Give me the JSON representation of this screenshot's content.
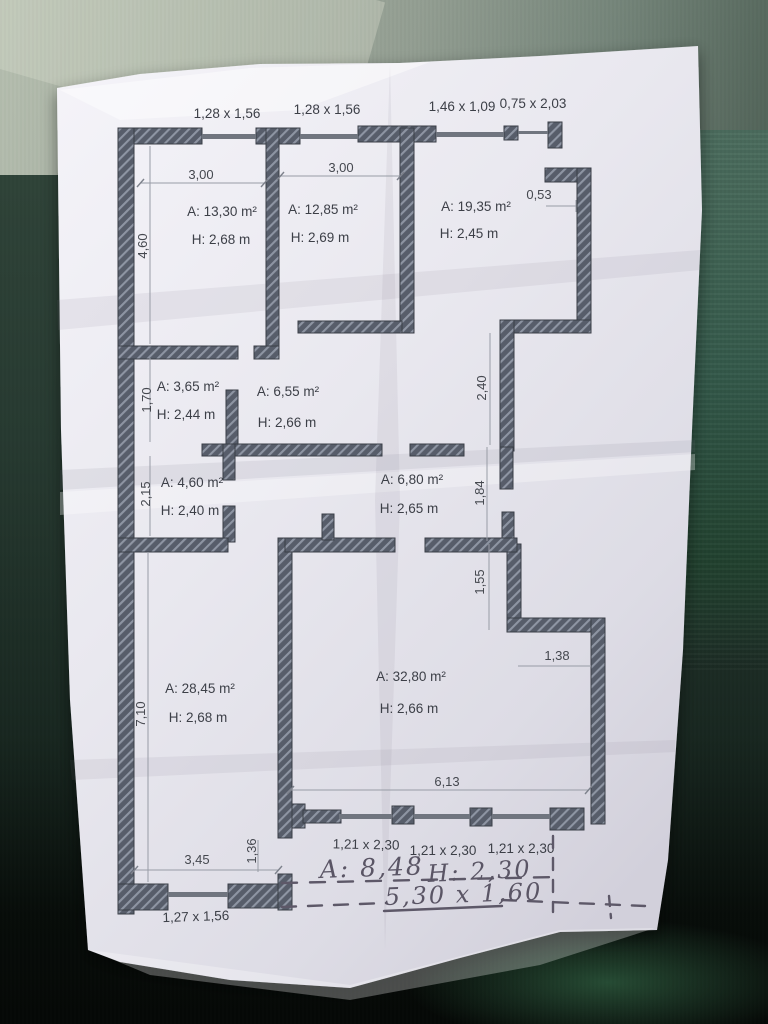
{
  "colors": {
    "paper": "#ebeaf1",
    "wall_fill": "#575d6a",
    "wall_hatch": "#8e95a3",
    "pencil": "#5a5565",
    "table_green": "#27523f",
    "table_top_gray": "#a3ad9f"
  },
  "plan": {
    "top_windows": [
      "1,28 x 1,56",
      "1,28 x 1,56",
      "1,46 x 1,09",
      "0,75 x 2,03"
    ],
    "rooms": {
      "r1": {
        "area": "A: 13,30 m²",
        "height": "H: 2,68 m"
      },
      "r2": {
        "area": "A: 12,85 m²",
        "height": "H: 2,69 m"
      },
      "r3": {
        "area": "A: 19,35 m²",
        "height": "H: 2,45 m"
      },
      "r4": {
        "area": "A: 3,65 m²",
        "height": "H: 2,44 m"
      },
      "r5": {
        "area": "A: 6,55 m²",
        "height": "H: 2,66 m"
      },
      "r6": {
        "area": "A: 4,60 m²",
        "height": "H: 2,40 m"
      },
      "r7": {
        "area": "A: 6,80 m²",
        "height": "H: 2,65 m"
      },
      "r8": {
        "area": "A: 28,45 m²",
        "height": "H: 2,68 m"
      },
      "r9": {
        "area": "A: 32,80 m²",
        "height": "H: 2,66 m"
      }
    },
    "dims": {
      "w1": "3,00",
      "w2": "3,00",
      "notch": "0,53",
      "left1": "4,60",
      "left2": "1,70",
      "left3": "2,15",
      "left4": "7,10",
      "right1": "2,40",
      "right2": "1,84",
      "right3": "1,55",
      "step": "1,38",
      "bottom_width": "6,13",
      "bottom_left_width": "3,45",
      "door": "1,36"
    },
    "bottom_windows": [
      "1,21 x 2,30",
      "1,21 x 2,30",
      "1,21 x 2,30"
    ],
    "bottom_left_window": "1,27 x 1,56",
    "handwriting": {
      "area": "A: 8,48",
      "height": "H: 2,30",
      "size": "5,30 x 1,60"
    }
  }
}
